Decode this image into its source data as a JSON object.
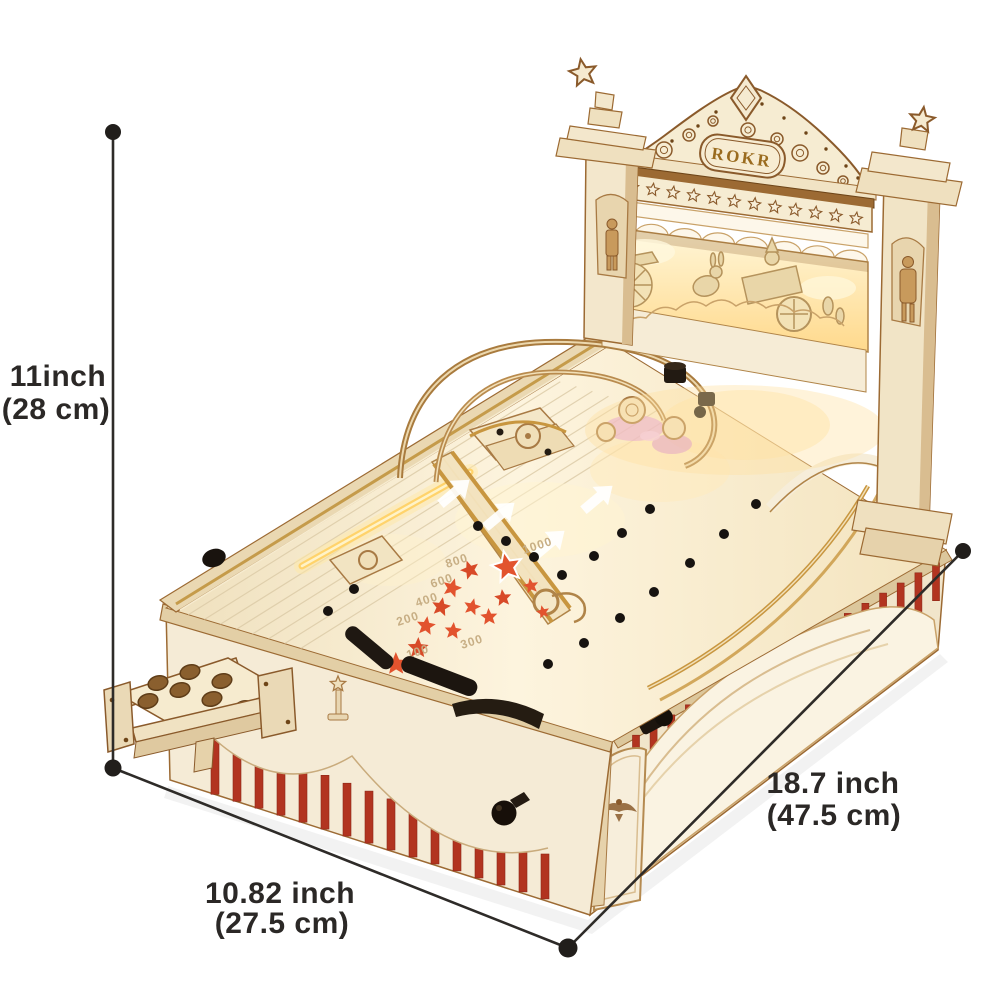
{
  "image_alt": "ROKR 3D wooden pinball machine puzzle shown with its dimensions",
  "brand": {
    "logo_text": "ROKR"
  },
  "dimensions": {
    "height": {
      "imperial": "11inch",
      "metric": "(28 cm)"
    },
    "depth": {
      "imperial": "10.82 inch",
      "metric": "(27.5 cm)"
    },
    "length": {
      "imperial": "18.7 inch",
      "metric": "(47.5 cm)"
    }
  },
  "playfield_scores": [
    "100",
    "200",
    "300",
    "400",
    "600",
    "800",
    "1000"
  ],
  "colors": {
    "stripe_red": "#b23420",
    "star_red": "#e2532e",
    "wood_cream": "#f6ecd8",
    "wood_brown": "#8a5a2b",
    "glow_warm": "#ffd98c",
    "dimension_line": "#2e2b28"
  }
}
